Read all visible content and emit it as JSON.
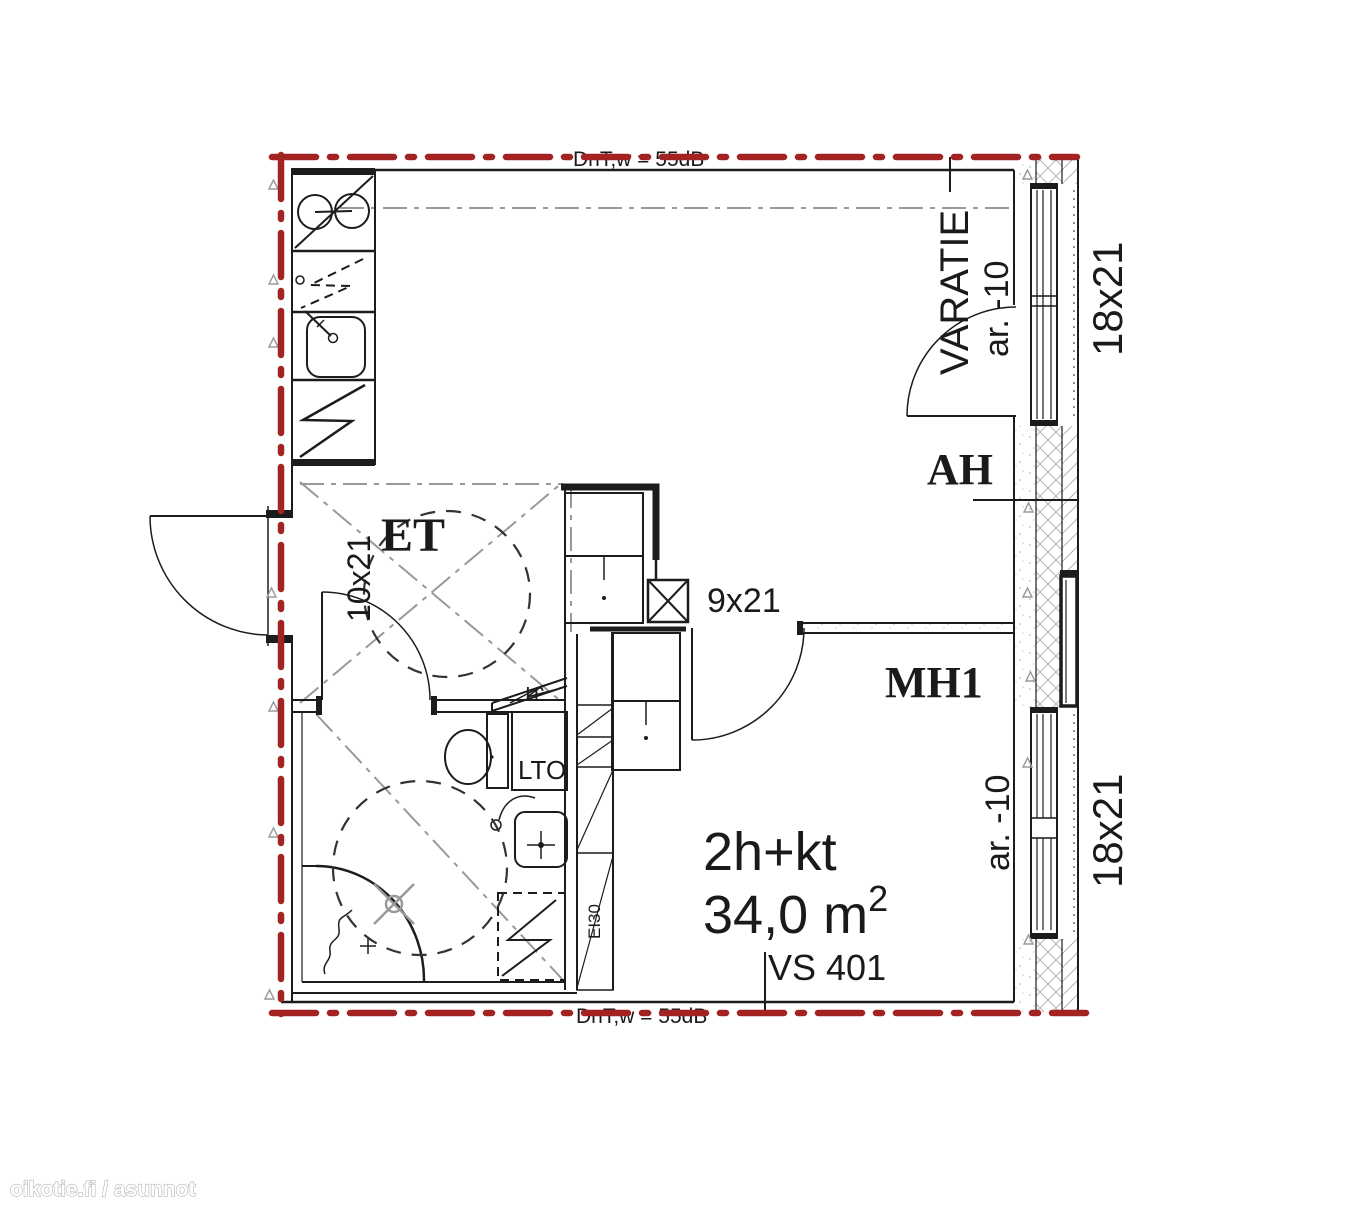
{
  "watermark": "oikotie.fi / asunnot",
  "apartment": {
    "type": "2h+kt",
    "area_value": "34,0 m",
    "area_exponent": "2",
    "plan_code": "VS 401"
  },
  "rooms": {
    "entry_hall": "ET",
    "living_room": "AH",
    "bedroom": "MH1"
  },
  "door_sizes": {
    "bathroom_door": "10x21",
    "bedroom_door": "9x21"
  },
  "window_sizes": {
    "top_window": "18x21",
    "bottom_window": "18x21"
  },
  "annotations": {
    "escape_route": "VARATIE",
    "elevation_top": "ar. -10",
    "elevation_bottom": "ar. -10",
    "sound_insulation_top": "DnT,w = 55dB",
    "sound_insulation_bottom": "DnT,w = 55dB",
    "heat_recovery_unit": "LTO",
    "cold_cabinet": "JT",
    "fire_rating": "EI30"
  },
  "colors": {
    "boundary": "#a32222",
    "lines": "#1c1c1c",
    "guides": "#999999"
  }
}
